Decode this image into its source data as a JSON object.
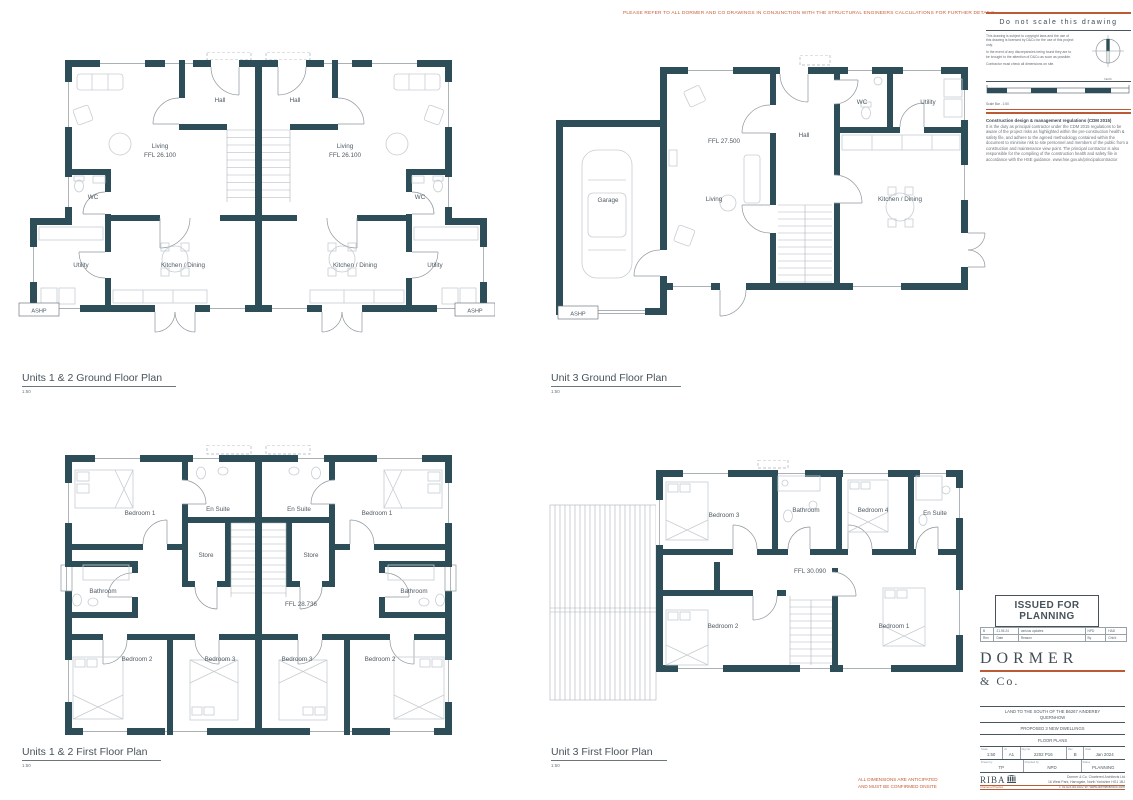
{
  "header_note": "PLEASE REFER TO ALL DORMER AND CO DRAWINGS IN CONJUNCTION WITH THE STRUCTURAL ENGINEERS CALCULATIONS FOR FURTHER DETAILS",
  "footer_note": {
    "line1": "ALL DIMENSIONS ARE ANTICIPATED",
    "line2": "AND MUST BE CONFIRMED ONSITE"
  },
  "plans": {
    "p1": {
      "title": "Units 1 & 2 Ground Floor Plan",
      "scale": "1:50",
      "rooms": {
        "hall": "Hall",
        "living": "Living",
        "living_ffl": "FFL 26.100",
        "wc": "WC",
        "utility": "Utility",
        "kitchen": "Kitchen / Dining",
        "ashp": "ASHP"
      }
    },
    "p2": {
      "title": "Unit 3 Ground Floor Plan",
      "scale": "1:50",
      "rooms": {
        "garage": "Garage",
        "living": "Living",
        "ffl": "FFL 27.500",
        "hall": "Hall",
        "wc": "WC",
        "utility": "Utility",
        "kitchen": "Kitchen / Dining",
        "ashp": "ASHP"
      }
    },
    "p3": {
      "title": "Units 1 & 2 First Floor Plan",
      "scale": "1:50",
      "rooms": {
        "bed1": "Bedroom 1",
        "bed2": "Bedroom 2",
        "bed3": "Bedroom 3",
        "ensuite": "En Suite",
        "store": "Store",
        "bathroom": "Bathroom",
        "ffl": "FFL 28.736"
      }
    },
    "p4": {
      "title": "Unit 3 First Floor Plan",
      "scale": "1:50",
      "rooms": {
        "bed1": "Bedroom 1",
        "bed2": "Bedroom 2",
        "bed3": "Bedroom 3",
        "bed4": "Bedroom 4",
        "bathroom": "Bathroom",
        "ensuite": "En Suite",
        "ffl": "FFL 30.090"
      }
    }
  },
  "titleblock": {
    "do_not_scale": "Do not scale this drawing",
    "note_copyright": "This drawing is subject to copyright laws and the use of this drawing is licensed by D&Co for the use of this project only.",
    "note_discrepancy": "In the event of any discrepancies being found they are to be brought to the attention of D&Co as soon as possible.",
    "note_dimensions": "Contractor must check all dimensions on site.",
    "north_label": "North",
    "scalebar_label": "Scale Bar - 1:50",
    "cdm_title": "Construction design & management regulations (CDM 2015)",
    "cdm_body": "It is the duty as principal contractor under the CDM 2015 regulations to be aware of the project risks as highlighted within the pre-construction health & safety file, and adhere to the agreed methodology contained within the document to minimise risk to site personnel and members of the public from a construction and maintenance view point. The principal contractor is also responsible for the compiling of the construction health and safety file in accordance with the HSE guidance. www.hse.gov.uk/principalcontractor",
    "issued_line1": "ISSUED FOR",
    "issued_line2": "PLANNING",
    "revision": {
      "rev": "B",
      "date": "21.05.24",
      "reason": "various updates",
      "by": "NPD",
      "chkd": "HAD",
      "h_rev": "Rev.",
      "h_date": "Date",
      "h_reason": "Reason",
      "h_by": "By",
      "h_chkd": "Chk'd"
    },
    "brand_name": "DORMER",
    "brand_suffix": "& Co.",
    "project": {
      "site_line1": "LAND TO THE SOUTH OF THE B6267 AINDERBY",
      "site_line2": "QUERNHOW",
      "description": "PROPOSED 3 NEW DWELLINGS",
      "sheet": "FLOOR PLANS",
      "h_scale": "Scale",
      "scale": "1:50",
      "h_size": "At",
      "size": "A1",
      "h_number": "Drg No.",
      "number": "2202 P16",
      "h_rev": "Rev",
      "rev": "B",
      "h_date": "Date",
      "date": "Jan 2024",
      "h_drawn": "Drawn by",
      "drawn": "TP",
      "h_checked": "Checked by",
      "checked": "NPD",
      "h_status": "Status",
      "status": "PLANNING"
    },
    "riba_name": "RIBA",
    "riba_sub": "Chartered Practice",
    "firm_line1": "Dormer & Co. Chartered Architects Ltd",
    "firm_line2": "16 West Park, Harrogate, North Yorkshire HG1 1BJ",
    "firm_line3": "T: 01423 851502  W: www.dormerandco.com"
  }
}
